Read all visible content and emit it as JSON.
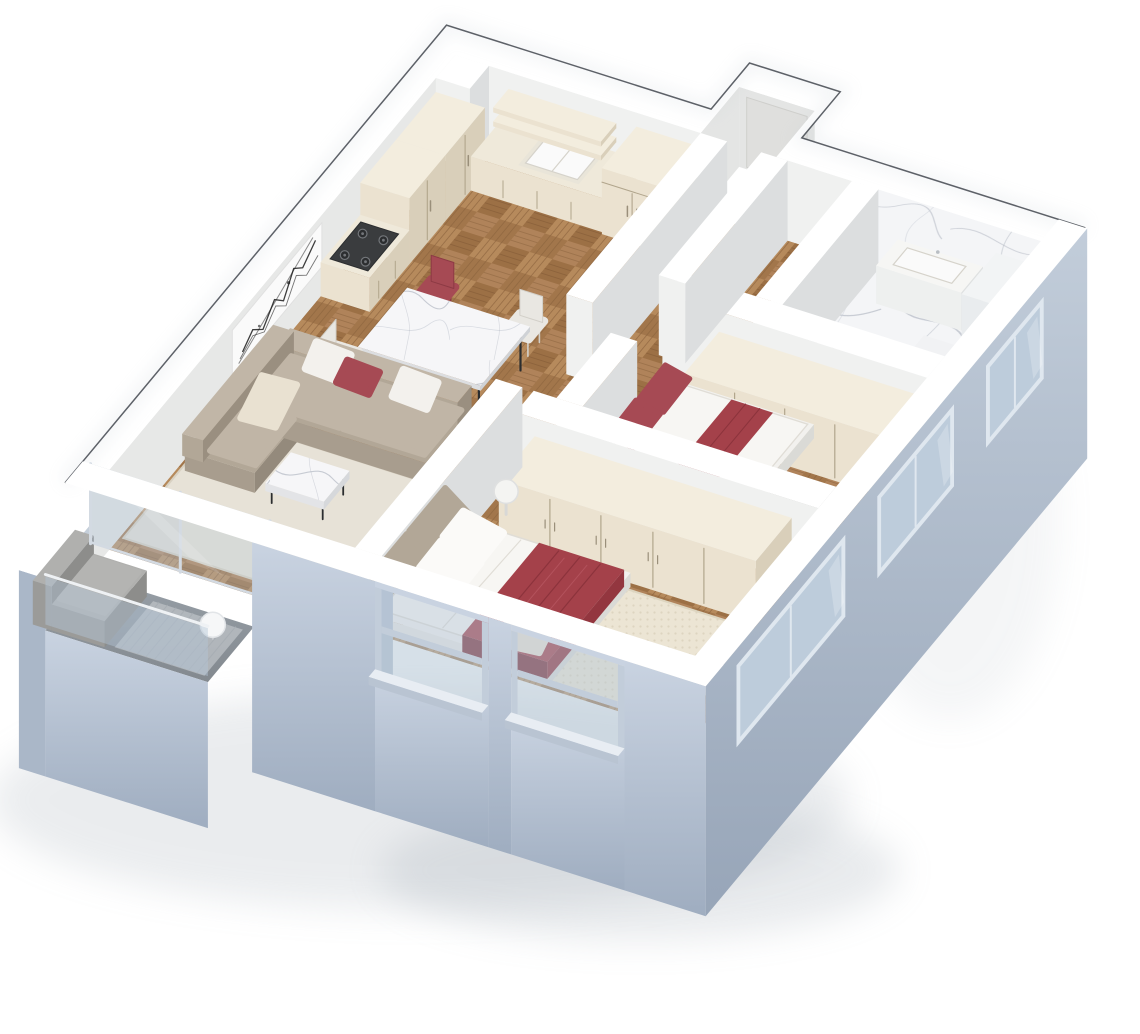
{
  "meta": {
    "description": "3D axonometric cutaway render of an apartment floor plan with open kitchen-dining-living area, hallway, bathroom, two bedrooms and a balcony",
    "background": "#ffffff",
    "style": "isometric-cutaway-architectural-render"
  },
  "rooms": [
    {
      "name": "kitchen-dining",
      "furniture": [
        "tall-cream-cabinets",
        "gas-hob",
        "floating-wall-shelves",
        "double-sink-counter",
        "pantry-cabinet",
        "marble-dining-table",
        "red-dining-chair",
        "white-dining-chair",
        "red-dining-chair-front",
        "white-dining-chair-side"
      ]
    },
    {
      "name": "living-room",
      "furniture": [
        "taupe-corner-sofa",
        "white-throw-pillows",
        "red-throw-pillow",
        "cream-throw-pillow",
        "abstract-wall-art",
        "marble-coffee-table",
        "light-area-rug"
      ]
    },
    {
      "name": "hallway",
      "furniture": []
    },
    {
      "name": "bathroom",
      "furniture": [
        "marble-wall",
        "marble-floor",
        "vanity-basin",
        "white-appliance-unit",
        "shower-base"
      ]
    },
    {
      "name": "bedroom-small",
      "furniture": [
        "bed-red-cushions",
        "red-folded-blanket",
        "grey-rug",
        "wardrobe-4-door"
      ]
    },
    {
      "name": "bedroom-master",
      "furniture": [
        "double-bed-white-duvet",
        "red-blanket",
        "taupe-headboard-cushions",
        "cream-accent-pillow",
        "wardrobe-5-door",
        "cream-woven-rug",
        "round-side-table",
        "sphere-floor-lamp"
      ]
    },
    {
      "name": "balcony",
      "furniture": [
        "grey-outdoor-sofa",
        "glass-railing",
        "deck-mat"
      ]
    }
  ],
  "palette": {
    "outline": "#42474e",
    "glow": "#b9c2cc",
    "shadow": "#9aa4af",
    "wallTop": "#ffffff",
    "wallTopShade": "#f2f5f8",
    "wallBright": "#f0f1f0",
    "wallMid": "#e7e8e7",
    "wallDim": "#dcdedf",
    "wallRecess": "#e4e5e4",
    "doorPanel": "#dfdfdd",
    "extLight": "#c9d3e1",
    "extMid": "#aab7c8",
    "extDark": "#96a4b7",
    "extCap": "#b6c2d1",
    "extInner": "#c5cfda",
    "frameLight": "#d3dae2",
    "glass": "#b4c6d6",
    "glassFrame": "#dfe7ef",
    "sill": "#dde4ec",
    "sillLip": "#b9c4d2",
    "wood1": "#b68a5c",
    "wood2": "#9c7045",
    "wood3": "#b0835a",
    "wood4": "#a2764b",
    "woodLine": "#7d5634",
    "woodBase": "#a87b4e",
    "marbleBase": "#f4f5f7",
    "marbleVein": "#a9afbb",
    "marbleVein2": "#ccd0d9",
    "marbleTable": "#f6f6f8",
    "cream1": "#ebe2d0",
    "cream2": "#d9cfba",
    "cream3": "#f3edde",
    "creamGap": "#b1a58c",
    "counter": "#efe9da",
    "handle": "#9a8f7a",
    "stove": "#3a3c3e",
    "stoveRing": "#73767a",
    "sink": "#fafafa",
    "sinkShade": "#d6d3cb",
    "steel": "#b9bec3",
    "leg": "#2b2d2f",
    "red": "#a64a54",
    "redDark": "#8c3a44",
    "redDeep": "#7d3039",
    "blanket": "#a4414a",
    "blanketHi": "#b3525c",
    "blanketLine": "#8c333c",
    "taupe": "#b2a797",
    "taupeDark": "#9a8f80",
    "taupeLight": "#c1b6a7",
    "sofaBase": "#a89d8e",
    "sofaSeat": "#c0b5a6",
    "sofaDark": "#948a7c",
    "pillowWhite": "#f3f1ed",
    "pillowCream": "#e9e1d1",
    "rugLight": "#e7e2d7",
    "rugBorder": "#d8d1c2",
    "rugGrey": "#b5b7b6",
    "rugGreyLine": "#a6a8a7",
    "rugCream": "#ece5d4",
    "rugDot": "#ddd5c0",
    "bedWhite": "#f2f1ee",
    "bedSide": "#e9e8e4",
    "bedEnd": "#dadad6",
    "duvet": "#f7f6f3",
    "duvetShade": "#e0ddd6",
    "deck": "#8f979f",
    "deckLine": "#a8aeb4",
    "mat": "#b7bcc1",
    "outSofa": "#9b9b99",
    "outSofaHi": "#b0b0ae",
    "outSofaDark": "#8d8d8b",
    "chairWhite": "#e9e7e2",
    "chairWhiteDark": "#d2cfc8",
    "vanity": "#f6f6f4",
    "unitWhite": "#f2f4f5",
    "artInk": "#1b1b1b",
    "canvas": "#fafafa"
  }
}
